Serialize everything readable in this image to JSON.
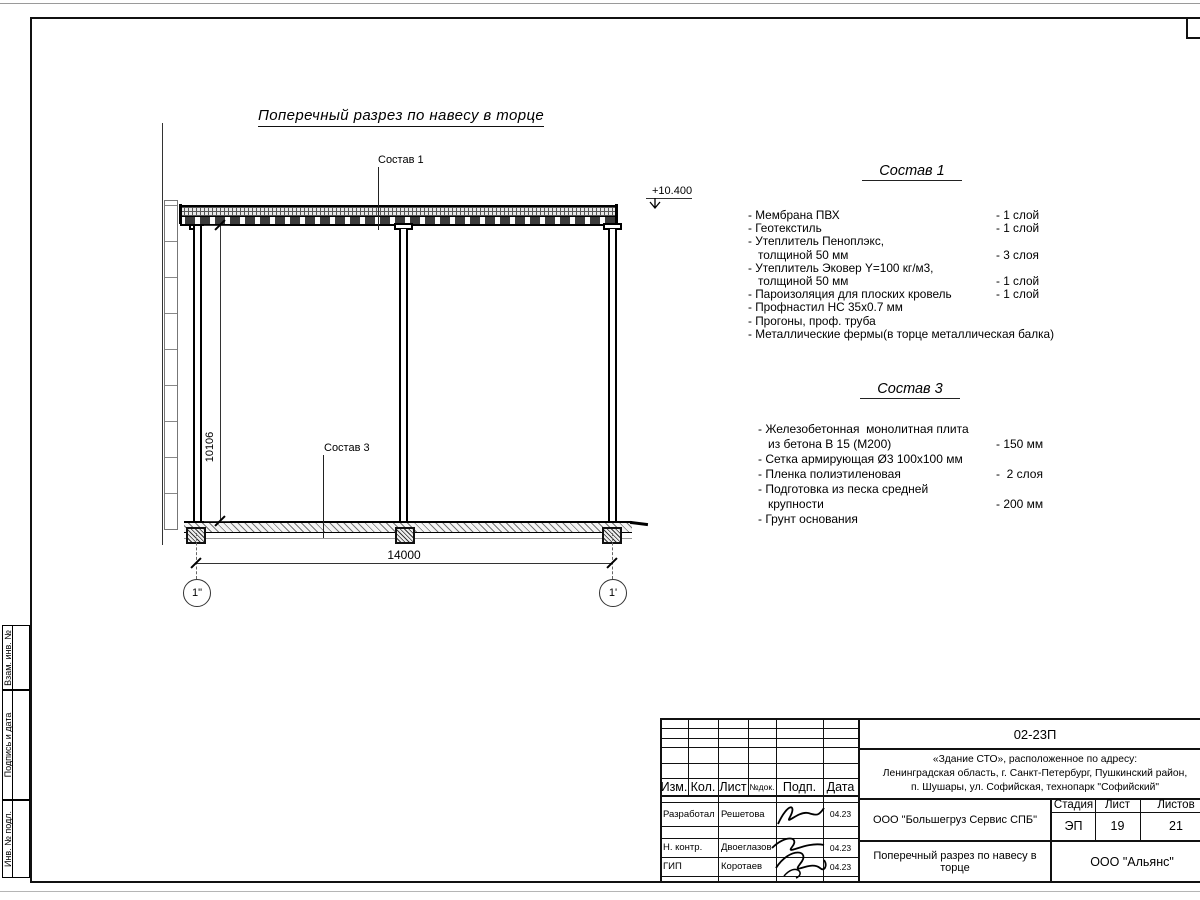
{
  "drawing": {
    "title": "Поперечный разрез по навесу в торце",
    "callout_sostav1": "Состав 1",
    "callout_sostav3": "Состав 3",
    "elevation": "+10.400",
    "dim_width": "14000",
    "dim_height": "10106",
    "axis_left": "1\"",
    "axis_right": "1'"
  },
  "sostav1": {
    "heading": "Состав 1",
    "items": [
      {
        "text": "- Мембрана ПВХ",
        "qty": "- 1 слой"
      },
      {
        "text": "- Геотекстиль",
        "qty": "- 1 слой"
      },
      {
        "text": "- Утеплитель Пеноплэкс,",
        "qty": ""
      },
      {
        "text": "толщиной 50 мм",
        "qty": "- 3 слоя"
      },
      {
        "text": "- Утеплитель Эковер Y=100 кг/м3,",
        "qty": ""
      },
      {
        "text": "толщиной 50 мм",
        "qty": "- 1 слой"
      },
      {
        "text": "- Пароизоляция для плоских кровель",
        "qty": "- 1 слой"
      },
      {
        "text": "- Профнастил НС 35х0.7 мм",
        "qty": ""
      },
      {
        "text": "- Прогоны, проф. труба",
        "qty": ""
      },
      {
        "text": "- Металлические фермы(в торце металлическая балка)",
        "qty": ""
      }
    ]
  },
  "sostav3": {
    "heading": "Состав 3",
    "items": [
      {
        "text": "- Железобетонная  монолитная плита",
        "qty": ""
      },
      {
        "text": "из бетона В 15 (М200)",
        "qty": "- 150 мм"
      },
      {
        "text": "- Сетка армирующая Ø3 100х100 мм",
        "qty": ""
      },
      {
        "text": "- Пленка полиэтиленовая",
        "qty": "-  2 слоя"
      },
      {
        "text": "- Подготовка из песка средней",
        "qty": ""
      },
      {
        "text": "крупности",
        "qty": "- 200 мм"
      },
      {
        "text": "- Грунт основания",
        "qty": ""
      }
    ]
  },
  "frame_labels": {
    "items": [
      "Взам. инв. №",
      "Подпись и дата",
      "Инв. № подл."
    ]
  },
  "titleblock": {
    "doc_code": "02-23П",
    "address_lines": [
      "«Здание СТО», расположенное по адресу:",
      "Ленинградская область, г. Санкт-Петербург, Пушкинский район,",
      "п. Шушары, ул. Софийская, технопарк \"Софийский\""
    ],
    "header": [
      "Изм.",
      "Кол.",
      "Лист",
      "№док.",
      "Подп.",
      "Дата"
    ],
    "rows": [
      {
        "role": "Разработал",
        "name": "Решетова",
        "date": "04.23"
      },
      {
        "role": "Н. контр.",
        "name": "Двоеглазов",
        "date": "04.23"
      },
      {
        "role": "ГИП",
        "name": "Коротаев",
        "date": "04.23"
      }
    ],
    "contractor": "ООО \"Большегруз Сервис СПБ\"",
    "stage_label": "Стадия",
    "sheet_label": "Лист",
    "sheets_label": "Листов",
    "stage": "ЭП",
    "sheet": "19",
    "sheets": "21",
    "doc_title": "Поперечный разрез по навесу в торце",
    "company": "ООО \"Альянс\""
  }
}
